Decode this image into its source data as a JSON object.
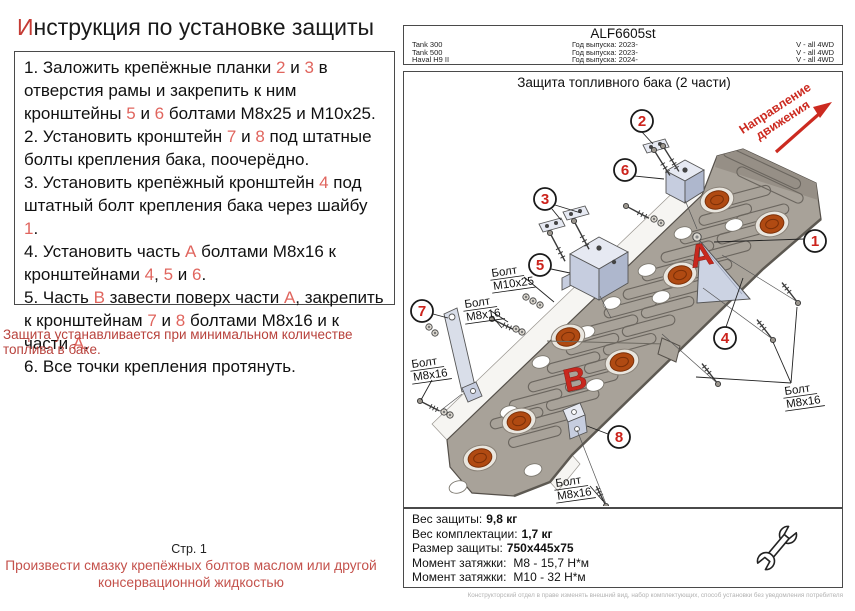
{
  "header": {
    "title_first": "И",
    "title_rest": "нструкция по установке защиты"
  },
  "instructions": {
    "steps": [
      {
        "segments": [
          {
            "t": "1. Заложить крепёжные планки "
          },
          {
            "t": "2",
            "red": true
          },
          {
            "t": " и "
          },
          {
            "t": "3",
            "red": true
          },
          {
            "t": " в отверстия рамы и закрепить к ним кронштейны "
          },
          {
            "t": "5",
            "red": true
          },
          {
            "t": " и "
          },
          {
            "t": "6",
            "red": true
          },
          {
            "t": " болтами М8х25 и М10х25."
          }
        ]
      },
      {
        "segments": [
          {
            "t": "2. Установить кронштейн "
          },
          {
            "t": "7",
            "red": true
          },
          {
            "t": " и "
          },
          {
            "t": "8",
            "red": true
          },
          {
            "t": " под штатные болты крепления бака, поочерёдно."
          }
        ]
      },
      {
        "segments": [
          {
            "t": "3. Установить крепёжный кронштейн "
          },
          {
            "t": "4",
            "red": true
          },
          {
            "t": " под штатный болт крепления бака через шайбу "
          },
          {
            "t": "1",
            "red": true
          },
          {
            "t": "."
          }
        ]
      },
      {
        "segments": [
          {
            "t": "4. Установить часть "
          },
          {
            "t": "А",
            "red": true
          },
          {
            "t": " болтами М8х16 к кронштейнами "
          },
          {
            "t": "4",
            "red": true
          },
          {
            "t": ", "
          },
          {
            "t": "5",
            "red": true
          },
          {
            "t": " и "
          },
          {
            "t": "6",
            "red": true
          },
          {
            "t": "."
          }
        ]
      },
      {
        "segments": [
          {
            "t": "5. Часть "
          },
          {
            "t": "В",
            "red": true
          },
          {
            "t": " завести поверх части "
          },
          {
            "t": "А",
            "red": true
          },
          {
            "t": ", закрепить к кронштейнам "
          },
          {
            "t": "7",
            "red": true
          },
          {
            "t": " и "
          },
          {
            "t": "8",
            "red": true
          },
          {
            "t": " болтами М8х16 и к части "
          },
          {
            "t": "А",
            "red": true
          },
          {
            "t": "."
          }
        ]
      },
      {
        "segments": [
          {
            "t": "6. Все точки крепления протянуть."
          }
        ]
      }
    ],
    "warning": "Защита устанавливается при минимальном количестве топлива в баке."
  },
  "vehicle_table": {
    "code": "ALF6605st",
    "rows": [
      {
        "model": "Tank 300",
        "year": "Год выпуска: 2023-",
        "drive": "V - all 4WD"
      },
      {
        "model": "Tank 500",
        "year": "Год выпуска: 2023-",
        "drive": "V - all 4WD"
      },
      {
        "model": "Haval H9 II",
        "year": "Год выпуска: 2024-",
        "drive": "V - all 4WD"
      }
    ]
  },
  "diagram": {
    "title": "Защита топливного бака (2 части)",
    "direction": {
      "line1": "Направление",
      "line2": "движения"
    },
    "part_a": "А",
    "part_b": "В",
    "callouts": [
      "1",
      "2",
      "3",
      "4",
      "5",
      "6",
      "7",
      "8"
    ],
    "bolt_labels": [
      {
        "line1": "Болт",
        "line2": "М10х25"
      },
      {
        "line1": "Болт",
        "line2": "М8х16"
      },
      {
        "line1": "Болт",
        "line2": "М8х16"
      },
      {
        "line1": "Болт",
        "line2": "М8х16"
      },
      {
        "line1": "Болт",
        "line2": "М8х16"
      }
    ]
  },
  "specs": {
    "rows": [
      {
        "label": "Вес защиты:",
        "value": "9,8 кг",
        "bold": true
      },
      {
        "label": "Вес комплектации:",
        "value": "1,7 кг",
        "bold": true
      },
      {
        "label": "Размер защиты:",
        "value": "750х445х75",
        "bold": true
      },
      {
        "label": "Момент затяжки:",
        "value": "М8 - 15,7 Н*м",
        "bold": false
      },
      {
        "label": "Момент затяжки:",
        "value": "М10 - 32 Н*м",
        "bold": false
      }
    ]
  },
  "footer": {
    "page": "Стр. 1",
    "note": "Произвести смазку крепёжных болтов маслом или другой консервационной жидкостью",
    "disclaimer": "Конструкторский отдел в праве изменять внешний вид, набор комплектующих, способ установки без уведомления потребителя"
  }
}
